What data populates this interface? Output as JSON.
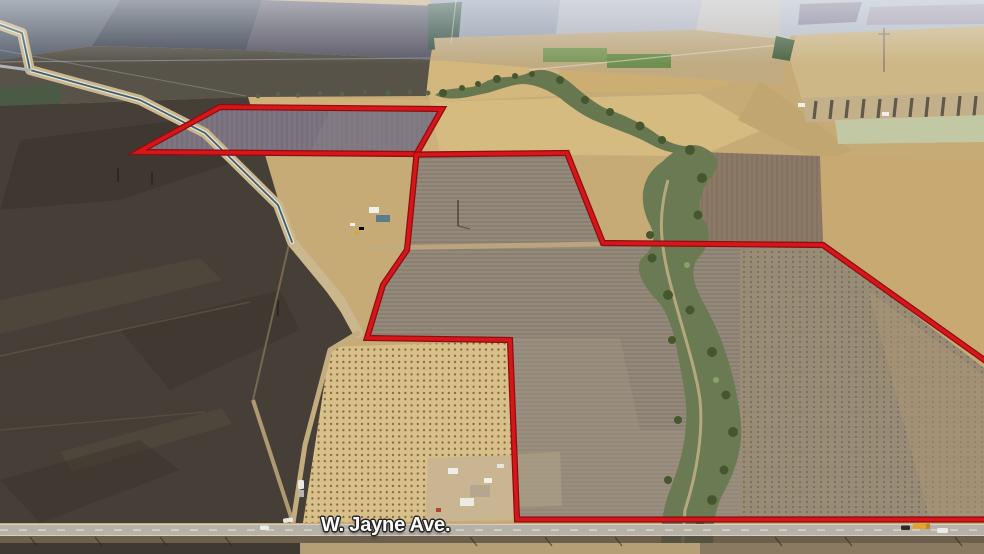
{
  "annotation": {
    "street_label": "W. Jayne Ave.",
    "boundary": {
      "stroke_color": "#d8161a",
      "edge_color": "#8d0f13",
      "stroke_width": 3.6,
      "edge_width": 6.2,
      "parcels": [
        {
          "id": "north-parcel",
          "points": [
            [
              220,
              107
            ],
            [
              442,
              109
            ],
            [
              416.5,
              154
            ],
            [
              138,
              152
            ]
          ]
        },
        {
          "id": "main-parcel",
          "points": [
            [
              416.5,
              154.5
            ],
            [
              567,
              153
            ],
            [
              603,
              243
            ],
            [
              823,
              245
            ],
            [
              1004,
              374
            ],
            [
              1004,
              519.5
            ],
            [
              517,
              519.5
            ],
            [
              510,
              340
            ],
            [
              367,
              338
            ],
            [
              383,
              285
            ],
            [
              407,
              250
            ]
          ]
        }
      ]
    }
  }
}
